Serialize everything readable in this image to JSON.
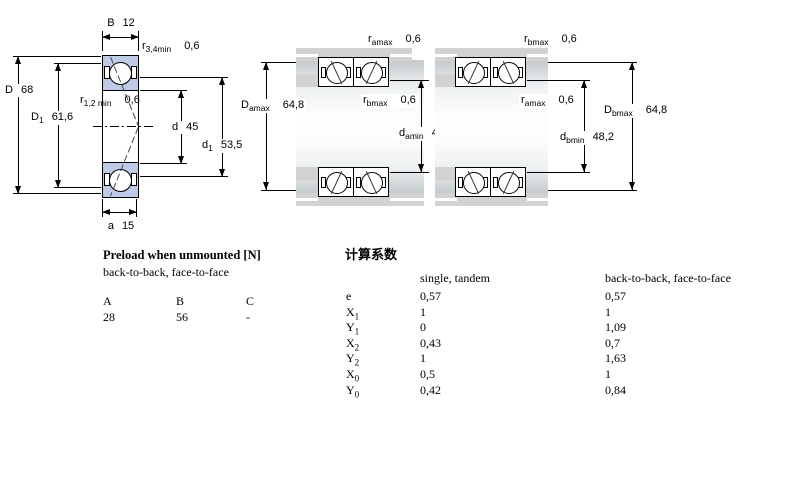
{
  "colors": {
    "c-line": "#000000",
    "c-blue": "#bfcbe6",
    "c-gray": "#d2d2d2",
    "c-shaft": "#c3c9cc"
  },
  "single_bearing": {
    "dims": {
      "B": {
        "base": "B",
        "value": "12"
      },
      "r34": {
        "base": "r",
        "sub": "3,4min",
        "value": "0,6"
      },
      "D": {
        "base": "D",
        "value": "68"
      },
      "D1": {
        "base": "D",
        "sub": "1",
        "value": "61,6"
      },
      "r12": {
        "base": "r",
        "sub": "1,2 min",
        "value": "0,6"
      },
      "d": {
        "base": "d",
        "value": "45"
      },
      "d1": {
        "base": "d",
        "sub": "1",
        "value": "53,5"
      },
      "a": {
        "base": "a",
        "value": "15"
      }
    }
  },
  "arrangement_a": {
    "dims": {
      "r_top": {
        "base": "r",
        "sub": "amax",
        "value": "0,6"
      },
      "D_max": {
        "base": "D",
        "sub": "amax",
        "value": "64,8"
      },
      "r_mid": {
        "base": "r",
        "sub": "bmax",
        "value": "0,6"
      },
      "d_min": {
        "base": "d",
        "sub": "amin",
        "value": "48,2"
      }
    }
  },
  "arrangement_b": {
    "dims": {
      "r_top": {
        "base": "r",
        "sub": "bmax",
        "value": "0,6"
      },
      "r_mid": {
        "base": "r",
        "sub": "amax",
        "value": "0,6"
      },
      "D_max": {
        "base": "D",
        "sub": "bmax",
        "value": "64,8"
      },
      "d_min": {
        "base": "d",
        "sub": "bmin",
        "value": "48,2"
      }
    }
  },
  "preload_table": {
    "title": "Preload when unmounted [N]",
    "subtitle": "back-to-back, face-to-face",
    "columns": [
      "A",
      "B",
      "C"
    ],
    "values": [
      "28",
      "56",
      "-"
    ]
  },
  "factors_table": {
    "title": "计算系数",
    "col1_header": "single, tandem",
    "col2_header": "back-to-back, face-to-face",
    "rows": [
      {
        "base": "e",
        "sub": "",
        "v1": "0,57",
        "v2": "0,57"
      },
      {
        "base": "X",
        "sub": "1",
        "v1": "1",
        "v2": "1"
      },
      {
        "base": "Y",
        "sub": "1",
        "v1": "0",
        "v2": "1,09"
      },
      {
        "base": "X",
        "sub": "2",
        "v1": "0,43",
        "v2": "0,7"
      },
      {
        "base": "Y",
        "sub": "2",
        "v1": "1",
        "v2": "1,63"
      },
      {
        "base": "X",
        "sub": "0",
        "v1": "0,5",
        "v2": "1"
      },
      {
        "base": "Y",
        "sub": "0",
        "v1": "0,42",
        "v2": "0,84"
      }
    ]
  }
}
